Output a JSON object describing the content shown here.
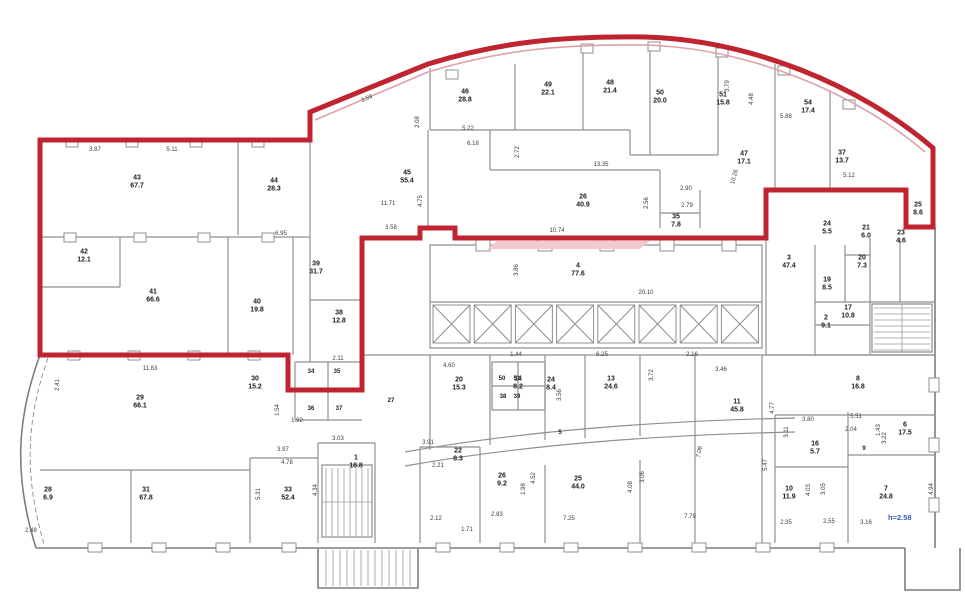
{
  "colors": {
    "selection_outline_red": "#bf2430",
    "facade_pink": "#dfa1a8",
    "wall_gray": "#8f8f8f",
    "note_blue": "#2e5bb7",
    "background": "#ffffff"
  },
  "note": {
    "text": "h=2.58",
    "x": 906,
    "y": 518
  },
  "rooms": [
    {
      "n": "43",
      "a": "67.7",
      "x": 137,
      "y": 182
    },
    {
      "n": "44",
      "a": "28.3",
      "x": 274,
      "y": 185
    },
    {
      "n": "42",
      "a": "12.1",
      "x": 84,
      "y": 256
    },
    {
      "n": "41",
      "a": "66.6",
      "x": 153,
      "y": 296
    },
    {
      "n": "40",
      "a": "19.8",
      "x": 257,
      "y": 306
    },
    {
      "n": "39",
      "a": "31.7",
      "x": 316,
      "y": 268
    },
    {
      "n": "38",
      "a": "12.8",
      "x": 339,
      "y": 317
    },
    {
      "n": "34",
      "a": "",
      "x": 311,
      "y": 372
    },
    {
      "n": "35",
      "a": "",
      "x": 337,
      "y": 372
    },
    {
      "n": "36",
      "a": "",
      "x": 311,
      "y": 409
    },
    {
      "n": "37",
      "a": "",
      "x": 339,
      "y": 409
    },
    {
      "n": "45",
      "a": "55.4",
      "x": 407,
      "y": 177
    },
    {
      "n": "46",
      "a": "28.8",
      "x": 465,
      "y": 96
    },
    {
      "n": "49",
      "a": "22.1",
      "x": 548,
      "y": 89
    },
    {
      "n": "48",
      "a": "21.4",
      "x": 610,
      "y": 87
    },
    {
      "n": "50",
      "a": "20.0",
      "x": 660,
      "y": 97
    },
    {
      "n": "51",
      "a": "15.8",
      "x": 723,
      "y": 99
    },
    {
      "n": "54",
      "a": "17.4",
      "x": 808,
      "y": 107
    },
    {
      "n": "47",
      "a": "17.1",
      "x": 744,
      "y": 158
    },
    {
      "n": "37",
      "a": "13.7",
      "x": 842,
      "y": 157
    },
    {
      "n": "26",
      "a": "40.9",
      "x": 583,
      "y": 201
    },
    {
      "n": "35",
      "a": "7.8",
      "x": 676,
      "y": 221
    },
    {
      "n": "25",
      "a": "8.6",
      "x": 918,
      "y": 209
    },
    {
      "n": "4",
      "a": "77.6",
      "x": 578,
      "y": 270
    },
    {
      "n": "3",
      "a": "47.4",
      "x": 789,
      "y": 262
    },
    {
      "n": "24",
      "a": "5.5",
      "x": 827,
      "y": 228
    },
    {
      "n": "21",
      "a": "6.0",
      "x": 866,
      "y": 232
    },
    {
      "n": "23",
      "a": "4.6",
      "x": 901,
      "y": 237
    },
    {
      "n": "20",
      "a": "7.3",
      "x": 862,
      "y": 262
    },
    {
      "n": "19",
      "a": "8.5",
      "x": 827,
      "y": 284
    },
    {
      "n": "17",
      "a": "10.8",
      "x": 848,
      "y": 312
    },
    {
      "n": "2",
      "a": "9.1",
      "x": 826,
      "y": 322
    },
    {
      "n": "8",
      "a": "16.8",
      "x": 858,
      "y": 383
    },
    {
      "n": "6",
      "a": "17.5",
      "x": 905,
      "y": 429
    },
    {
      "n": "9",
      "a": "",
      "x": 864,
      "y": 449
    },
    {
      "n": "16",
      "a": "5.7",
      "x": 815,
      "y": 448
    },
    {
      "n": "11",
      "a": "45.8",
      "x": 737,
      "y": 406
    },
    {
      "n": "10",
      "a": "11.9",
      "x": 789,
      "y": 493
    },
    {
      "n": "7",
      "a": "24.8",
      "x": 886,
      "y": 493
    },
    {
      "n": "13",
      "a": "24.6",
      "x": 611,
      "y": 383
    },
    {
      "n": "14",
      "a": "8.2",
      "x": 518,
      "y": 383
    },
    {
      "n": "24",
      "a": "8.4",
      "x": 551,
      "y": 384
    },
    {
      "n": "20",
      "a": "15.3",
      "x": 459,
      "y": 384
    },
    {
      "n": "22",
      "a": "8.3",
      "x": 458,
      "y": 455
    },
    {
      "n": "26",
      "a": "9.2",
      "x": 502,
      "y": 480
    },
    {
      "n": "25",
      "a": "44.0",
      "x": 578,
      "y": 483
    },
    {
      "n": "27",
      "a": "",
      "x": 391,
      "y": 401
    },
    {
      "n": "28",
      "a": "6.9",
      "x": 48,
      "y": 494
    },
    {
      "n": "31",
      "a": "67.8",
      "x": 146,
      "y": 494
    },
    {
      "n": "33",
      "a": "52.4",
      "x": 288,
      "y": 494
    },
    {
      "n": "29",
      "a": "66.1",
      "x": 140,
      "y": 402
    },
    {
      "n": "30",
      "a": "15.2",
      "x": 255,
      "y": 383
    },
    {
      "n": "1",
      "a": "18.8",
      "x": 356,
      "y": 462
    },
    {
      "n": "5",
      "a": "",
      "x": 560,
      "y": 433
    },
    {
      "n": "50",
      "a": "",
      "x": 502,
      "y": 379
    },
    {
      "n": "51",
      "a": "",
      "x": 517,
      "y": 379
    },
    {
      "n": "38",
      "a": "",
      "x": 503,
      "y": 397
    },
    {
      "n": "39",
      "a": "",
      "x": 517,
      "y": 397
    }
  ],
  "dimensions": [
    {
      "t": "3.87",
      "x": 95,
      "y": 150
    },
    {
      "t": "5.11",
      "x": 172,
      "y": 150
    },
    {
      "t": "6.95",
      "x": 281,
      "y": 234
    },
    {
      "t": "2.41",
      "x": 58,
      "y": 385,
      "r": -90
    },
    {
      "t": "11.83",
      "x": 150,
      "y": 369
    },
    {
      "t": "3.59",
      "x": 367,
      "y": 99,
      "r": -23
    },
    {
      "t": "2.08",
      "x": 418,
      "y": 122,
      "r": -90
    },
    {
      "t": "5.22",
      "x": 468,
      "y": 129
    },
    {
      "t": "6.18",
      "x": 473,
      "y": 144
    },
    {
      "t": "2.72",
      "x": 518,
      "y": 152,
      "r": -90
    },
    {
      "t": "13.35",
      "x": 601,
      "y": 165
    },
    {
      "t": "10.74",
      "x": 557,
      "y": 231
    },
    {
      "t": "11.71",
      "x": 388,
      "y": 204
    },
    {
      "t": "4.75",
      "x": 421,
      "y": 201,
      "r": -90
    },
    {
      "t": "3.58",
      "x": 391,
      "y": 228
    },
    {
      "t": "2.90",
      "x": 686,
      "y": 189
    },
    {
      "t": "2.79",
      "x": 687,
      "y": 206
    },
    {
      "t": "2.56",
      "x": 647,
      "y": 203,
      "r": -90
    },
    {
      "t": "10.26",
      "x": 735,
      "y": 177,
      "r": -75
    },
    {
      "t": "5.88",
      "x": 786,
      "y": 117
    },
    {
      "t": "4.48",
      "x": 752,
      "y": 99,
      "r": -90
    },
    {
      "t": "3.79",
      "x": 728,
      "y": 86,
      "r": -90
    },
    {
      "t": "5.12",
      "x": 849,
      "y": 176
    },
    {
      "t": "3.46",
      "x": 721,
      "y": 370
    },
    {
      "t": "20.10",
      "x": 646,
      "y": 293
    },
    {
      "t": "3.86",
      "x": 517,
      "y": 270,
      "r": -90
    },
    {
      "t": "4.60",
      "x": 449,
      "y": 366
    },
    {
      "t": "1.44",
      "x": 516,
      "y": 355
    },
    {
      "t": "6.25",
      "x": 602,
      "y": 355
    },
    {
      "t": "2.16",
      "x": 692,
      "y": 355
    },
    {
      "t": "3.72",
      "x": 652,
      "y": 375,
      "r": -90
    },
    {
      "t": "3.56",
      "x": 560,
      "y": 395,
      "r": -90
    },
    {
      "t": "1.98",
      "x": 524,
      "y": 489,
      "r": -90
    },
    {
      "t": "4.52",
      "x": 534,
      "y": 478,
      "r": -90
    },
    {
      "t": "2.83",
      "x": 497,
      "y": 515
    },
    {
      "t": "7.25",
      "x": 569,
      "y": 519
    },
    {
      "t": "7.79",
      "x": 690,
      "y": 517
    },
    {
      "t": "4.08",
      "x": 631,
      "y": 487,
      "r": -90
    },
    {
      "t": "3.06",
      "x": 643,
      "y": 477,
      "r": -90
    },
    {
      "t": "7.08",
      "x": 700,
      "y": 452,
      "r": -78
    },
    {
      "t": "4.77",
      "x": 773,
      "y": 408,
      "r": -90
    },
    {
      "t": "3.80",
      "x": 808,
      "y": 420
    },
    {
      "t": "3.11",
      "x": 787,
      "y": 432,
      "r": -90
    },
    {
      "t": "5.51",
      "x": 856,
      "y": 417
    },
    {
      "t": "2.04",
      "x": 851,
      "y": 430
    },
    {
      "t": "1.43",
      "x": 879,
      "y": 430,
      "r": -90
    },
    {
      "t": "3.22",
      "x": 885,
      "y": 438,
      "r": -90
    },
    {
      "t": "5.47",
      "x": 766,
      "y": 465,
      "r": -90
    },
    {
      "t": "3.05",
      "x": 824,
      "y": 489,
      "r": -90
    },
    {
      "t": "4.03",
      "x": 809,
      "y": 490,
      "r": -90
    },
    {
      "t": "2.35",
      "x": 786,
      "y": 523
    },
    {
      "t": "2.55",
      "x": 829,
      "y": 522
    },
    {
      "t": "3.16",
      "x": 866,
      "y": 523
    },
    {
      "t": "4.94",
      "x": 932,
      "y": 489,
      "r": -90
    },
    {
      "t": "2.48",
      "x": 31,
      "y": 531
    },
    {
      "t": "3.03",
      "x": 338,
      "y": 439
    },
    {
      "t": "3.97",
      "x": 283,
      "y": 450
    },
    {
      "t": "4.78",
      "x": 287,
      "y": 463
    },
    {
      "t": "5.31",
      "x": 259,
      "y": 494,
      "r": -90
    },
    {
      "t": "4.34",
      "x": 316,
      "y": 490,
      "r": -90
    },
    {
      "t": "1.92",
      "x": 297,
      "y": 421
    },
    {
      "t": "1.54",
      "x": 278,
      "y": 410,
      "r": -90
    },
    {
      "t": "2.21",
      "x": 438,
      "y": 466
    },
    {
      "t": "3.91",
      "x": 428,
      "y": 443
    },
    {
      "t": "2.12",
      "x": 436,
      "y": 519
    },
    {
      "t": "1.71",
      "x": 467,
      "y": 530
    },
    {
      "t": "2.11",
      "x": 338,
      "y": 359
    }
  ]
}
